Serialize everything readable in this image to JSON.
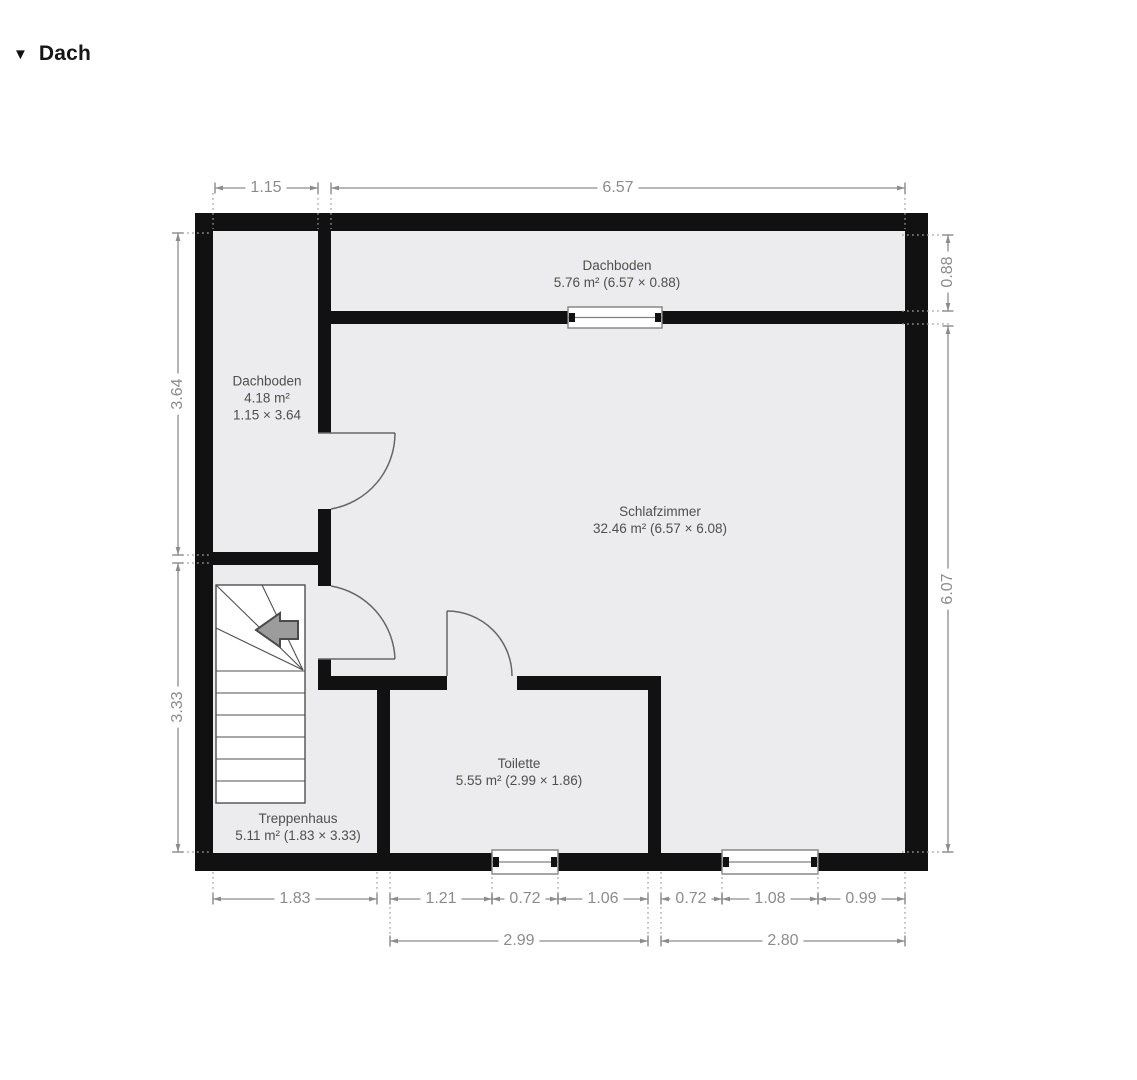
{
  "header": {
    "collapse_icon": "▼",
    "title": "Dach"
  },
  "rooms": {
    "dachboden_top": {
      "name": "Dachboden",
      "details": "5.76 m² (6.57 × 0.88)"
    },
    "dachboden_left": {
      "name": "Dachboden",
      "area": "4.18 m²",
      "size": "1.15 × 3.64"
    },
    "schlafzimmer": {
      "name": "Schlafzimmer",
      "details": "32.46 m² (6.57 × 6.08)"
    },
    "toilette": {
      "name": "Toilette",
      "details": "5.55 m² (2.99 × 1.86)"
    },
    "treppenhaus": {
      "name": "Treppenhaus",
      "details": "5.11 m² (1.83 × 3.33)"
    }
  },
  "dimensions": {
    "top": {
      "w1": "1.15",
      "w2": "6.57"
    },
    "right": {
      "h1": "0.88",
      "h2": "6.07"
    },
    "left": {
      "h1": "3.64",
      "h2": "3.33"
    },
    "bottom_upper": {
      "d1": "1.83",
      "d2": "1.21",
      "d3": "0.72",
      "d4": "1.06",
      "d5": "0.72",
      "d6": "1.08",
      "d7": "0.99"
    },
    "bottom_lower": {
      "d1": "2.99",
      "d2": "2.80"
    }
  },
  "colors": {
    "wall": "#111111",
    "floor": "#ececee",
    "dimension": "#8c8c8c",
    "room_text": "#4f4f4f",
    "stair_line": "#4f4f4f",
    "door_arc": "#666666"
  }
}
